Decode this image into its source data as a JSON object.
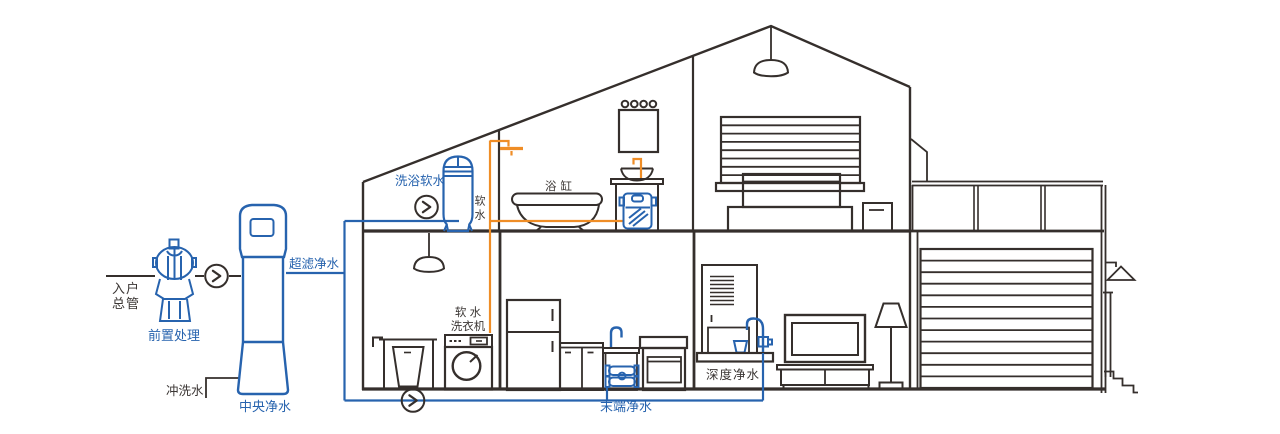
{
  "labels": {
    "main_inlet": [
      "入户",
      "总管"
    ],
    "pre_treatment": "前置处理",
    "ultrafiltration": "超滤净水",
    "flush_water": "冲洗水",
    "central_purification": "中央净水",
    "bath_soft_water": "洗浴软水",
    "soft_water": "软水",
    "bathtub": "浴缸",
    "soft_water_washer": [
      "软 水",
      "洗衣机"
    ],
    "terminal_purification": "末端净水",
    "deep_purification": "深度净水"
  },
  "icons": {
    "flow_direction": "chevron-right-in-circle"
  },
  "colors": {
    "purified_water_pipe": "#2763ae",
    "soft_water_pipe": "#ef8d26",
    "line_art": "#352f2c",
    "background": "#ffffff"
  }
}
